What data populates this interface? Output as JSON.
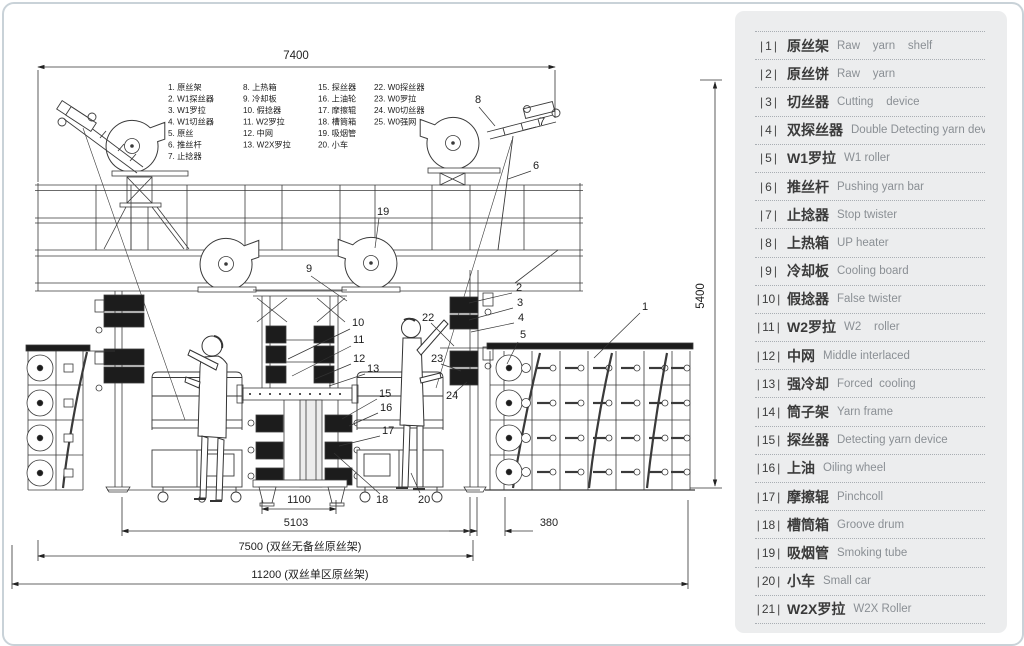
{
  "drawing": {
    "dimensions": {
      "top_width": "7400",
      "height": "5400",
      "center_base": "1100",
      "machine_base": "5103",
      "rack_gap": "380",
      "total_no_spare": "7500 (双丝无备丝原丝架)",
      "total_single_zone": "11200 (双丝单区原丝架)"
    },
    "parts_list": {
      "col1": [
        "1. 原丝架",
        "2. W1探丝器",
        "3. W1罗拉",
        "4. W1切丝器",
        "5. 原丝",
        "6. 推丝杆",
        "7. 止捻器"
      ],
      "col2": [
        "8. 上热箱",
        "9. 冷却板",
        "10. 假捻器",
        "11. W2罗拉",
        "12. 中网",
        "13. W2X罗拉"
      ],
      "col3": [
        "15. 探丝器",
        "16. 上油轮",
        "17. 摩擦辊",
        "18. 槽筒箱",
        "19. 吸烟管",
        "20. 小车"
      ],
      "col4": [
        "22. W0探丝器",
        "23. W0罗拉",
        "24. W0切丝器",
        "25. W0强网"
      ]
    },
    "callouts": [
      "1",
      "2",
      "3",
      "4",
      "5",
      "6",
      "7",
      "8",
      "9",
      "10",
      "11",
      "12",
      "13",
      "15",
      "16",
      "17",
      "18",
      "19",
      "20",
      "22",
      "23",
      "24"
    ]
  },
  "legend": {
    "items": [
      {
        "num": "1",
        "cn": "原丝架",
        "en": "Raw    yarn    shelf"
      },
      {
        "num": "2",
        "cn": "原丝饼",
        "en": "Raw    yarn"
      },
      {
        "num": "3",
        "cn": "切丝器",
        "en": "Cutting    device"
      },
      {
        "num": "4",
        "cn": "双探丝器",
        "en": "Double Detecting yarn device"
      },
      {
        "num": "5",
        "cn": "W1罗拉",
        "en": "W1 roller"
      },
      {
        "num": "6",
        "cn": "推丝杆",
        "en": "Pushing yarn bar"
      },
      {
        "num": "7",
        "cn": "止捻器",
        "en": "Stop twister"
      },
      {
        "num": "8",
        "cn": "上热箱",
        "en": "UP heater"
      },
      {
        "num": "9",
        "cn": "冷却板",
        "en": "Cooling board"
      },
      {
        "num": "10",
        "cn": "假捻器",
        "en": "False twister"
      },
      {
        "num": "11",
        "cn": "W2罗拉",
        "en": "W2    roller"
      },
      {
        "num": "12",
        "cn": "中网",
        "en": "Middle interlaced"
      },
      {
        "num": "13",
        "cn": "强冷却",
        "en": "Forced  cooling"
      },
      {
        "num": "14",
        "cn": "筒子架",
        "en": "Yarn frame"
      },
      {
        "num": "15",
        "cn": "探丝器",
        "en": "Detecting yarn device"
      },
      {
        "num": "16",
        "cn": "上油",
        "en": "Oiling wheel"
      },
      {
        "num": "17",
        "cn": "摩擦辊",
        "en": "Pinchcoll"
      },
      {
        "num": "18",
        "cn": "槽筒箱",
        "en": "Groove drum"
      },
      {
        "num": "19",
        "cn": "吸烟管",
        "en": "Smoking tube"
      },
      {
        "num": "20",
        "cn": "小车",
        "en": "Small car"
      },
      {
        "num": "21",
        "cn": "W2X罗拉",
        "en": "W2X Roller"
      }
    ]
  }
}
